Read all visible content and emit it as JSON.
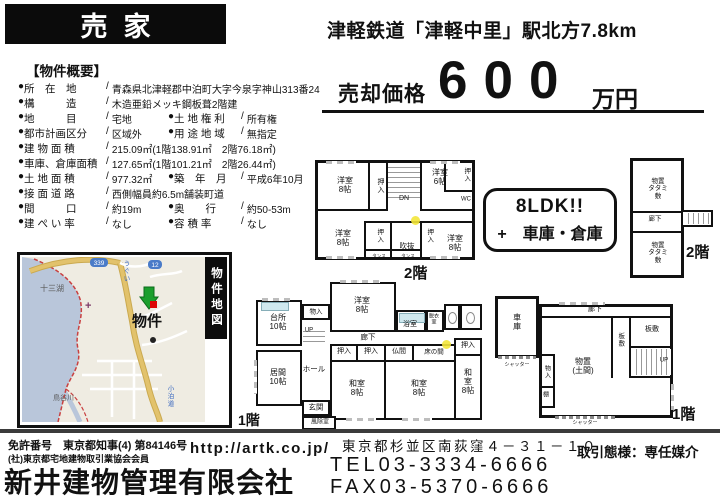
{
  "header": {
    "title": "売家",
    "station_line": "津軽鉄道「津軽中里」駅北方7.8km"
  },
  "price": {
    "label": "売却価格",
    "amount": "600",
    "unit": "万円"
  },
  "overview": {
    "section_title": "【物件概要】",
    "rows": [
      [
        {
          "label": "所　在　地",
          "value": "青森県北津軽郡中泊町大字今泉字神山313番24"
        }
      ],
      [
        {
          "label": "構　　　造",
          "value": "木造亜鉛メッキ鋼板葺2階建"
        }
      ],
      [
        {
          "label": "地　　　目",
          "value": "宅地"
        },
        {
          "label": "土 地 権 利",
          "value": "所有権"
        }
      ],
      [
        {
          "label": "都市計画区分",
          "value": "区域外"
        },
        {
          "label": "用 途 地 域",
          "value": "無指定"
        }
      ],
      [
        {
          "label": "建 物 面 積",
          "value": "215.09㎡(1階138.91㎡　2階76.18㎡)"
        }
      ],
      [
        {
          "label": "車庫、倉庫面積",
          "value": "127.65㎡(1階101.21㎡　2階26.44㎡)"
        }
      ],
      [
        {
          "label": "土 地 面 積",
          "value": "977.32㎡"
        },
        {
          "label": "築　年　月",
          "value": "平成6年10月"
        }
      ],
      [
        {
          "label": "接 面 道 路",
          "value": "西側幅員約6.5m舗装町道"
        }
      ],
      [
        {
          "label": "間　　　口",
          "value": "約19m"
        },
        {
          "label": "奥　　行",
          "value": "約50-53m"
        }
      ],
      [
        {
          "label": "建 ぺ い 率",
          "value": "なし"
        },
        {
          "label": "容 積 率",
          "value": "なし"
        }
      ]
    ]
  },
  "badge": {
    "line1": "8LDK!!",
    "line2": "+　車庫・倉庫"
  },
  "map": {
    "tab": "物件地図",
    "property_label": "物件",
    "lake_label": "十三湖",
    "river_label": "鳥谷川",
    "road_label_bottom": "小泊道",
    "road_label_top": "うぐい",
    "route_shield_left": "339",
    "route_shield_right": "12"
  },
  "plans": {
    "house2f": {
      "floor_label": "2階",
      "rooms": [
        {
          "t": "洋室\n8帖",
          "x": 27,
          "y": 22
        },
        {
          "t": "押入",
          "x": 62,
          "y": 23,
          "v": 1,
          "s": 7
        },
        {
          "t": "DN",
          "x": 86,
          "y": 36,
          "s": 7
        },
        {
          "t": "洋室\n6帖",
          "x": 122,
          "y": 14
        },
        {
          "t": "押入",
          "x": 148,
          "y": 12,
          "v": 1,
          "s": 6.5
        },
        {
          "t": "WC",
          "x": 148,
          "y": 37,
          "s": 6
        },
        {
          "t": "洋室\n8帖",
          "x": 25,
          "y": 75
        },
        {
          "t": "押入",
          "x": 61,
          "y": 73,
          "v": 1,
          "s": 6.5
        },
        {
          "t": "吹抜",
          "x": 89,
          "y": 84,
          "s": 7.5
        },
        {
          "t": "タンス",
          "x": 61,
          "y": 93,
          "s": 4.5
        },
        {
          "t": "タンス",
          "x": 90,
          "y": 93,
          "s": 4.5
        },
        {
          "t": "押入",
          "x": 111,
          "y": 73,
          "v": 1,
          "s": 6.5
        },
        {
          "t": "洋室\n8帖",
          "x": 137,
          "y": 80
        }
      ]
    },
    "house1f": {
      "floor_label": "1階",
      "rooms": [
        {
          "t": "洋室\n8帖",
          "x": 106,
          "y": 23
        },
        {
          "t": "物入",
          "x": 60,
          "y": 30,
          "s": 6.5
        },
        {
          "t": "台所\n10帖",
          "x": 22,
          "y": 40
        },
        {
          "t": "浴室",
          "x": 154,
          "y": 43,
          "s": 7
        },
        {
          "t": "脱衣\n室",
          "x": 178,
          "y": 38,
          "s": 5
        },
        {
          "t": "UP",
          "x": 53,
          "y": 49,
          "s": 6
        },
        {
          "t": "廊下",
          "x": 112,
          "y": 56,
          "s": 7.5
        },
        {
          "t": "居間\n10帖",
          "x": 22,
          "y": 95
        },
        {
          "t": "ホール",
          "x": 58,
          "y": 88,
          "s": 7.5
        },
        {
          "t": "玄関",
          "x": 60,
          "y": 126,
          "s": 7.5
        },
        {
          "t": "風除室",
          "x": 64,
          "y": 141,
          "s": 6
        },
        {
          "t": "押入",
          "x": 88,
          "y": 70,
          "s": 7
        },
        {
          "t": "押入",
          "x": 115,
          "y": 70,
          "s": 7
        },
        {
          "t": "仏間",
          "x": 143,
          "y": 70,
          "s": 7
        },
        {
          "t": "床の間",
          "x": 178,
          "y": 70,
          "s": 6.5
        },
        {
          "t": "和室\n8帖",
          "x": 101,
          "y": 106
        },
        {
          "t": "和室\n8帖",
          "x": 163,
          "y": 106
        },
        {
          "t": "押入",
          "x": 212,
          "y": 64,
          "s": 7
        },
        {
          "t": "和室\n8帖",
          "x": 212,
          "y": 100
        }
      ]
    },
    "garage1f": {
      "floor_label": "1階",
      "rooms": [
        {
          "t": "車庫",
          "x": 22,
          "y": 32,
          "v": 1,
          "s": 8
        },
        {
          "t": "シャッター",
          "x": 22,
          "y": 76,
          "s": 5
        },
        {
          "t": "廊下",
          "x": 100,
          "y": 20,
          "s": 7
        },
        {
          "t": "板敷",
          "x": 125,
          "y": 50,
          "v": 1,
          "s": 6.5
        },
        {
          "t": "板敷",
          "x": 157,
          "y": 40,
          "s": 7
        },
        {
          "t": "UP",
          "x": 169,
          "y": 71,
          "s": 6
        },
        {
          "t": "物置\n(土間)",
          "x": 88,
          "y": 76,
          "s": 8
        },
        {
          "t": "物入",
          "x": 51,
          "y": 82,
          "v": 1,
          "s": 6
        },
        {
          "t": "棚",
          "x": 51,
          "y": 106,
          "s": 6
        },
        {
          "t": "シャッター",
          "x": 90,
          "y": 134,
          "s": 5
        }
      ]
    },
    "storage2f": {
      "floor_label": "2階",
      "rooms": [
        {
          "t": "物置\nタタミ敷",
          "x": 25,
          "y": 28,
          "s": 6.5
        },
        {
          "t": "廊下",
          "x": 22,
          "y": 58,
          "s": 6.5
        },
        {
          "t": "物置\nタタミ敷",
          "x": 25,
          "y": 92,
          "s": 6.5
        }
      ]
    }
  },
  "footer": {
    "license_no": "免許番号　東京都知事(4) 第84146号",
    "association": "(社)東京都宅地建物取引業協会会員",
    "company": "新井建物管理有限会社",
    "url": "http://artk.co.jp/",
    "address": "東京都杉並区南荻窪４－３１－１０",
    "tel": "TEL03-3334-6666",
    "fax": "FAX03-5370-6666",
    "deal_type": "取引態様：専任媒介"
  },
  "colors": {
    "ink": "#111111",
    "lake": "#b9c6da",
    "road": "#d9b45c",
    "boundary_red": "#c94040",
    "marker_green": "#1b9e2d",
    "marker_red": "#dd0404",
    "highlight_yellow": "#f3e53a"
  }
}
